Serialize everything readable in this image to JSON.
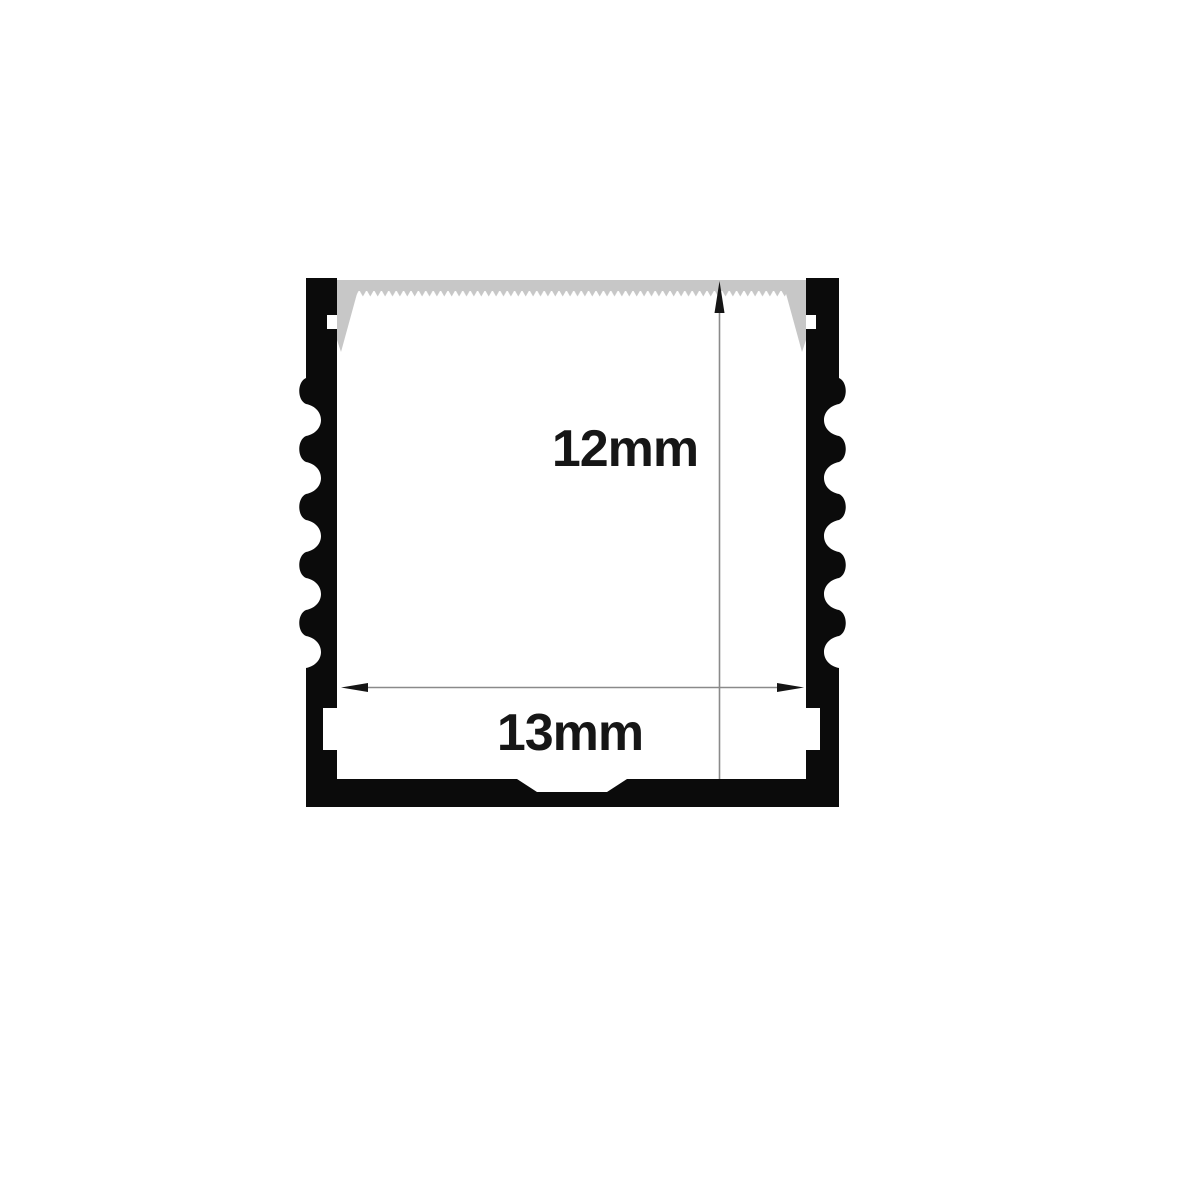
{
  "diagram": {
    "title": "LED aluminium profile cross-section",
    "type": "technical-dimension-drawing",
    "dimensions": [
      {
        "id": "inner-height",
        "label": "12mm",
        "orientation": "vertical"
      },
      {
        "id": "inner-width",
        "label": "13mm",
        "orientation": "horizontal"
      }
    ],
    "colors": {
      "background": "#ffffff",
      "aluminium": "#0b0b0b",
      "diffuser": "#c7c7c7",
      "dimension_line": "#8a8a8a",
      "arrowhead": "#151515",
      "label_text": "#161616"
    }
  }
}
